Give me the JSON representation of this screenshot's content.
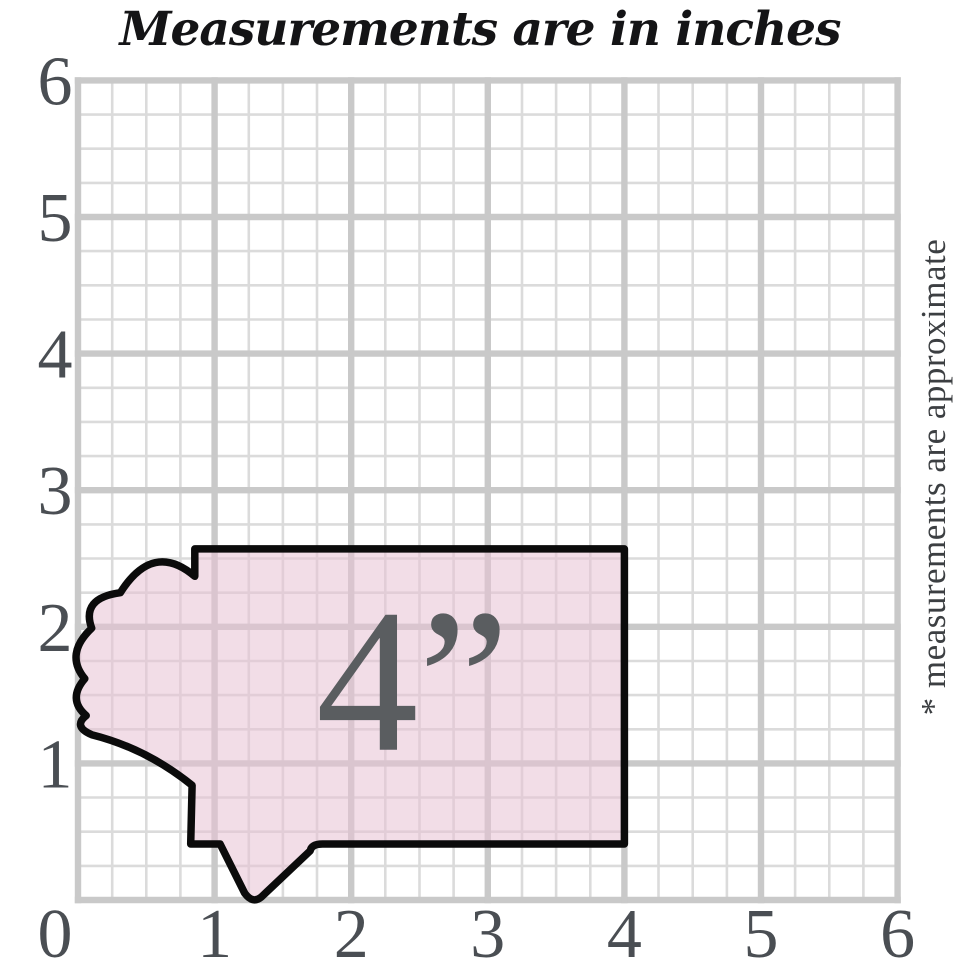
{
  "title": "Measurements are in inches",
  "side_note": "* measurements are approximate",
  "grid": {
    "min": 0,
    "max": 6,
    "minor_per_unit": 4,
    "origin_px": {
      "x": 78,
      "y": 900
    },
    "unit_px": 136.6,
    "major_width": 6.4,
    "minor_width": 2.6
  },
  "axes": {
    "x_ticks": [
      0,
      1,
      2,
      3,
      4,
      5,
      6
    ],
    "y_ticks": [
      1,
      2,
      3,
      4,
      5,
      6
    ]
  },
  "shape": {
    "label": "4”",
    "label_pos_in": {
      "x": 2.45,
      "y": 1.1
    },
    "fill_opacity": 0.55,
    "stroke_width_px": 7.5,
    "outline_in": [
      [
        "M",
        4.0,
        0.41
      ],
      [
        "L",
        4.0,
        2.57
      ],
      [
        "L",
        0.855,
        2.57
      ],
      [
        "L",
        0.855,
        2.37
      ],
      [
        "Q",
        0.55,
        2.63,
        0.31,
        2.25
      ],
      [
        "Q",
        0.02,
        2.21,
        0.1,
        1.99
      ],
      [
        "Q",
        -0.1,
        1.8,
        0.05,
        1.62
      ],
      [
        "Q",
        -0.08,
        1.47,
        0.06,
        1.35
      ],
      [
        "Q",
        -0.04,
        1.27,
        0.1,
        1.21
      ],
      [
        "Q",
        0.5,
        1.11,
        0.835,
        0.84
      ],
      [
        "L",
        0.825,
        0.41
      ],
      [
        "L",
        1.04,
        0.41
      ],
      [
        "L",
        1.22,
        0.05
      ],
      [
        "Q",
        1.28,
        -0.03,
        1.34,
        0.02
      ],
      [
        "L",
        1.7,
        0.36
      ],
      [
        "Q",
        1.71,
        0.41,
        1.79,
        0.41
      ],
      [
        "Z"
      ]
    ]
  },
  "colors": {
    "background": "#ffffff",
    "title": "#141416",
    "side_note": "#3c3f42",
    "tick": "#4a4e53",
    "grid_major": "#c9c9c9",
    "grid_minor": "#dbdbdb",
    "shape_fill": "#e7c1d3",
    "shape_outline": "#0b0b0b",
    "shape_label": "#5a5d60"
  }
}
